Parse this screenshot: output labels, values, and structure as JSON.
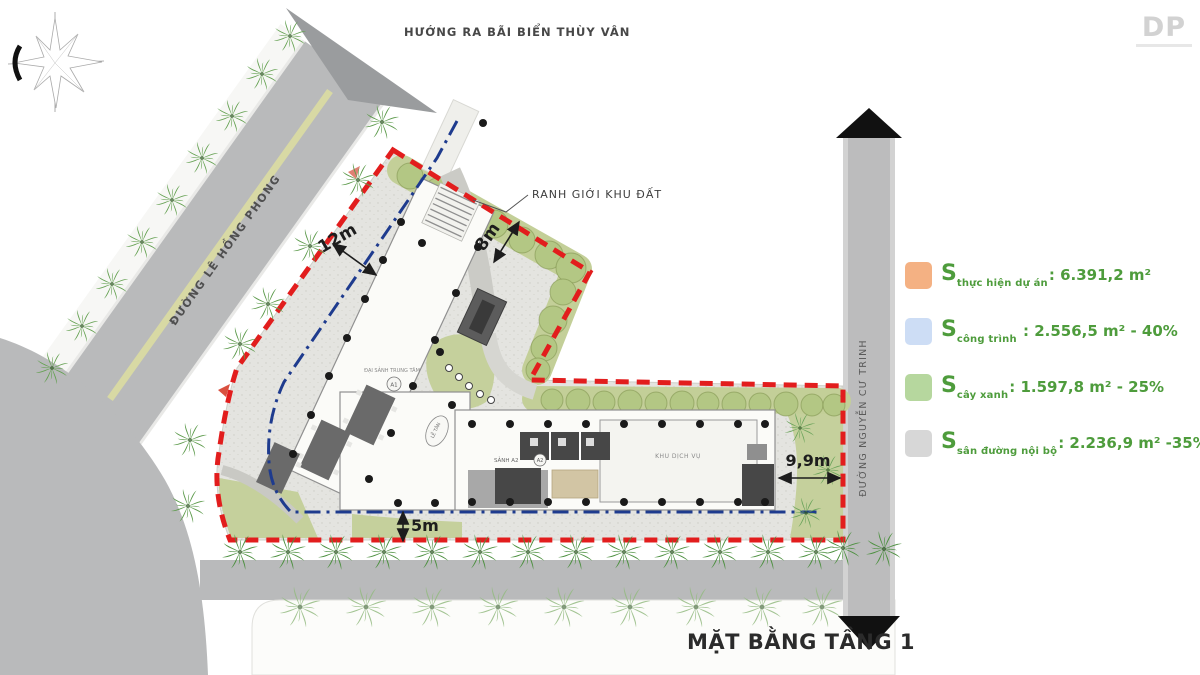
{
  "logo": {
    "text": "DP"
  },
  "header": {
    "direction_label": "HƯỚNG RA BÃI BIỂN THÙY VÂN"
  },
  "roads": {
    "left_label": "ĐƯỜNG LÊ HỒNG PHONG",
    "right_label": "ĐƯỜNG NGUYỄN CƯ TRINH"
  },
  "site": {
    "boundary_label": "RANH GIỚI KHU ĐẤT",
    "dimensions": {
      "nw_setback": "12m",
      "ne_setback": "8m",
      "south_setback": "5m",
      "east_setback": "9,9m"
    },
    "building": {
      "main_hall": "ĐẠI SẢNH TRUNG TÂM",
      "block_a1": "A1",
      "reception": "LỄ TÂN",
      "hall_a2": "SẢNH A2",
      "block_a2": "A2",
      "service_area": "KHU DỊCH VỤ"
    }
  },
  "legend": {
    "items": [
      {
        "id": "s-thuc-hien-du-an",
        "swatch_color": "#f4b183",
        "prefix": "S",
        "subscript": "thực hiện dự án",
        "value": ": 6.391,2 m²"
      },
      {
        "id": "s-cong-trinh",
        "swatch_color": "#cdddf5",
        "prefix": "S",
        "subscript": "công trình",
        "value": " : 2.556,5 m² - 40%"
      },
      {
        "id": "s-cay-xanh",
        "swatch_color": "#b6d79e",
        "prefix": "S",
        "subscript": "cây xanh",
        "value": ": 1.597,8 m² - 25%"
      },
      {
        "id": "s-san-duong-noi-bo",
        "swatch_color": "#d7d7d7",
        "prefix": "S",
        "subscript": "sân đường nội bộ",
        "value": ": 2.236,9 m² -35%"
      }
    ],
    "text_color": "#4e9c3c"
  },
  "title": "MẶT BẰNG TẦNG 1",
  "colors": {
    "boundary_red": "#e21d1d",
    "setback_blue": "#1e3b8e",
    "road_gray": "#b9babb",
    "greenery": "#c5d09c",
    "paving": "#e4e4e0"
  }
}
